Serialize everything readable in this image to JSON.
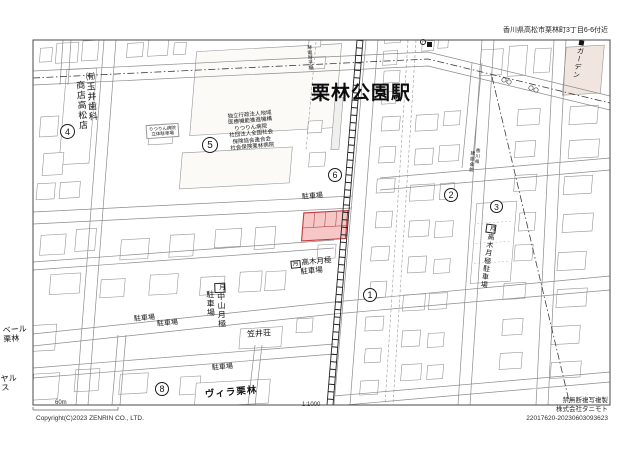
{
  "header": {
    "address": "香川県高松市栗林町3丁目6-6付近"
  },
  "station": {
    "name": "栗林公園駅",
    "line_label": "琴電琴平線"
  },
  "labels": {
    "tamai1": "㈲玉井歯科",
    "tamai2": "商店高松店",
    "hospital_lines": [
      "独立行政法人地域",
      "医療機能推進機構",
      "りつりん病院",
      "社団法人全国社会",
      "保険協会連合会",
      "社会保険栗林病院"
    ],
    "deck1": "りつりん病院",
    "deck2": "立体駐車場",
    "kensetsu1": "香川県",
    "kensetsu2": "建設会館",
    "garden": "ガーデン",
    "kasai": "笠井荘",
    "villa": "ヴィラ栗林",
    "belle1": "ベール",
    "belle2": "栗林",
    "yaru1": "ヤル",
    "yaru2": "ス"
  },
  "parking": {
    "lot": "駐車場",
    "monthly_box": "月",
    "takagi": "高木月極",
    "nakayama": "中山月極"
  },
  "markers": {
    "m1": "1",
    "m2": "2",
    "m3": "3",
    "m4": "4",
    "m5": "5",
    "m6": "6",
    "m8": "8"
  },
  "colors": {
    "highlight_fill": "#f7c6c6",
    "highlight_border": "#c43a3a",
    "garden_fill": "#f0e6df",
    "boundary_line": "#3c3c3c"
  },
  "footer": {
    "scale_distance": "60m",
    "scale_ratio": "1:1000",
    "copyright": "Copyright(C)2023 ZENRIN CO., LTD.",
    "notice": "禁無断複写複製",
    "company": "株式会社タニモト",
    "serial": "22017620-20230603093623"
  }
}
